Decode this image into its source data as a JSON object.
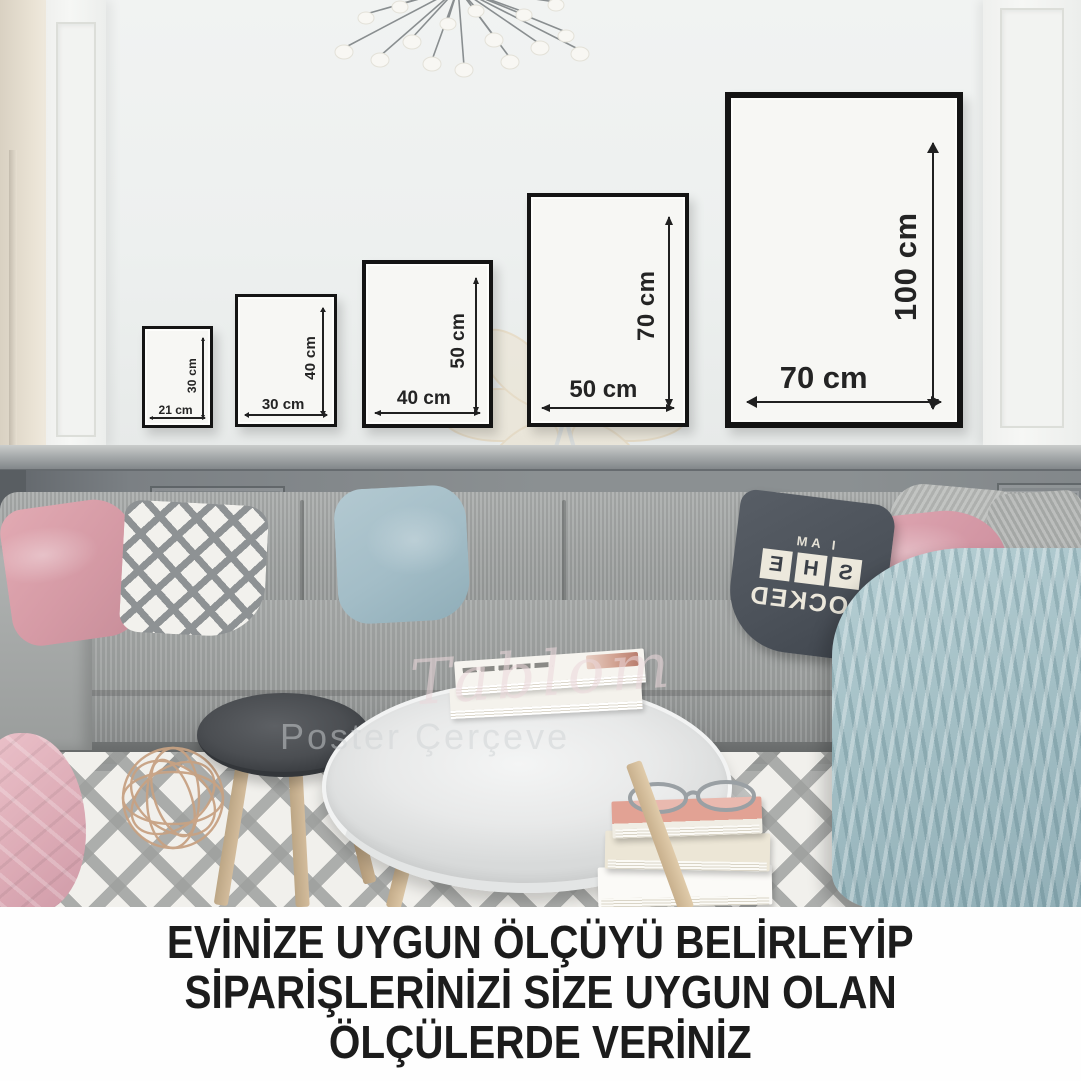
{
  "frames": [
    {
      "name": "21x30",
      "width_label": "21 cm",
      "height_label": "30 cm"
    },
    {
      "name": "30x40",
      "width_label": "30 cm",
      "height_label": "40 cm"
    },
    {
      "name": "40x50",
      "width_label": "40 cm",
      "height_label": "50 cm"
    },
    {
      "name": "50x70",
      "width_label": "50 cm",
      "height_label": "70 cm"
    },
    {
      "name": "70x100",
      "width_label": "70 cm",
      "height_label": "100 cm"
    }
  ],
  "caption": {
    "line1": "EVİNİZE UYGUN ÖLÇÜYÜ BELİRLEYİP",
    "line2": "SİPARİŞLERİNİZİ SİZE UYGUN OLAN",
    "line3": "ÖLÇÜLERDE VERİNİZ"
  },
  "watermark": {
    "script": "Tablom",
    "sub": "Poster   Çerçeve"
  },
  "sher_pillow": {
    "line1": "I AM",
    "tiles": [
      "S",
      "H",
      "E"
    ],
    "line2": "LOCKED"
  },
  "colors": {
    "frame_border": "#141414",
    "wall": "#edf0ef",
    "wainscot": "#8b9092",
    "caption_text": "#1c1c1c",
    "blanket": "#a3bfc5",
    "pink_pillow": "#d59aa5",
    "blue_pillow": "#a3bdc7",
    "dark_pillow": "#4c525a"
  }
}
